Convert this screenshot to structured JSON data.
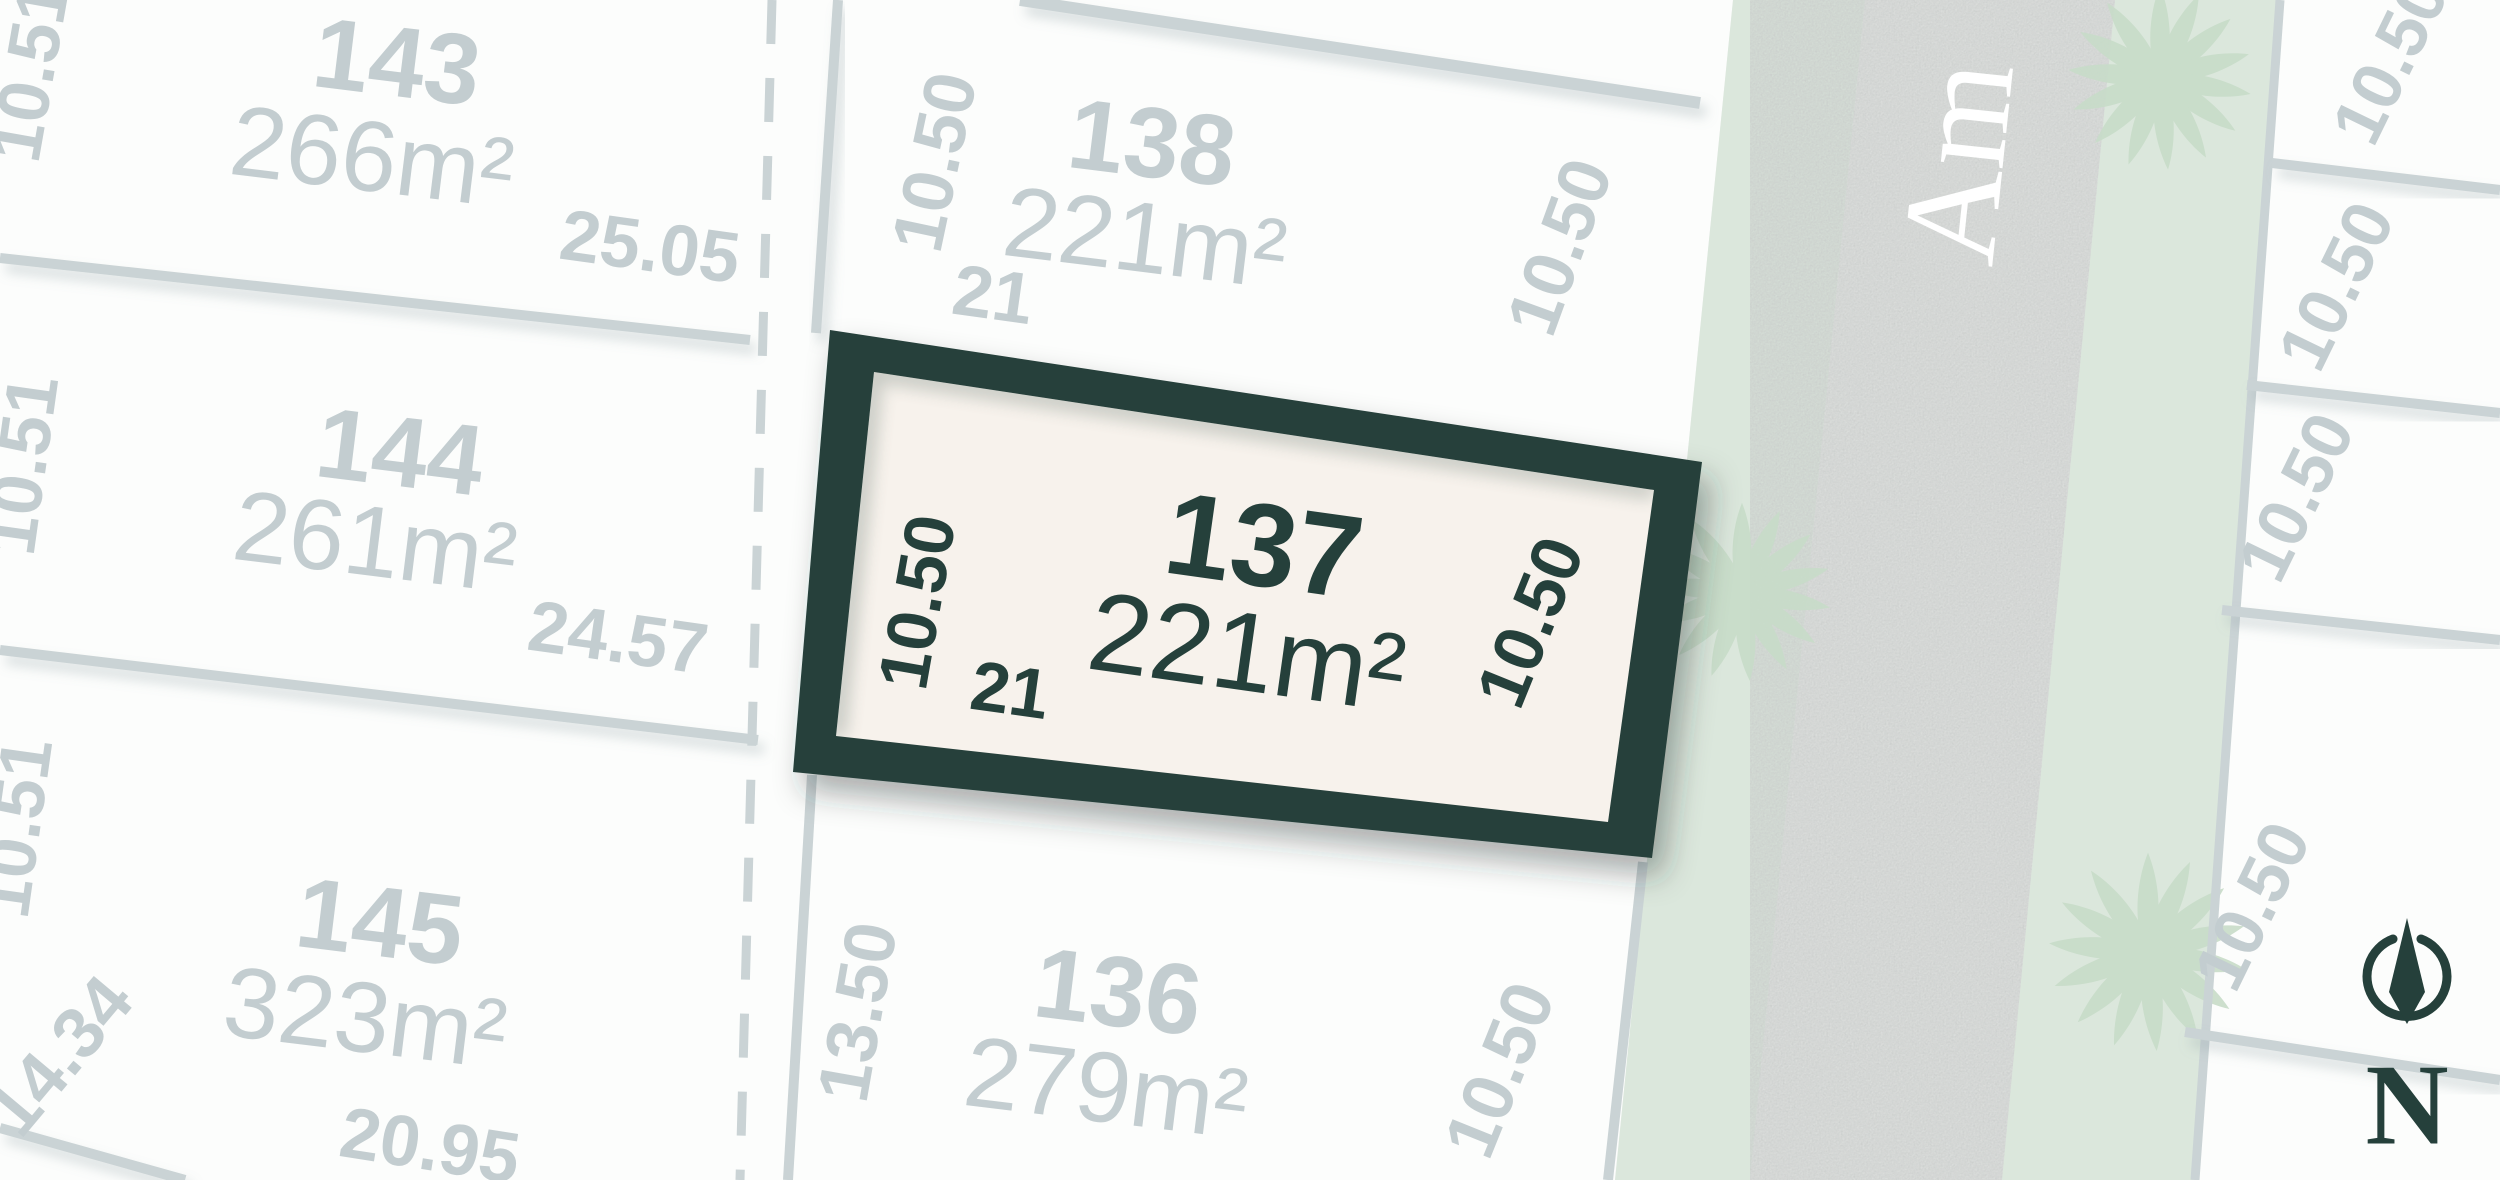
{
  "colors": {
    "accent_dark": "#25403b",
    "label_gray": "#c3cdd0",
    "line_gray": "#cad3d5",
    "lot_fill": "#fcfdfc",
    "background": "#eef1f0",
    "road_fill": "#e4e6e4",
    "verge_green": "#dbe7dc",
    "tree_green": "#c8dcc9",
    "highlight_fill": "#f7f2ec",
    "street_text": "#ffffff"
  },
  "highlight_lot": {
    "number": "137",
    "area": "221m²",
    "dim_left": "10.50",
    "dim_frontage": "21",
    "dim_right": "10.50"
  },
  "lots": {
    "l143": {
      "number": "143",
      "area": "266m²",
      "dim_side": "10.51",
      "dim_rear": "25.05"
    },
    "l144": {
      "number": "144",
      "area": "261m²",
      "dim_side": "10.51",
      "dim_rear": "24.57"
    },
    "l145": {
      "number": "145",
      "area": "323m²",
      "dim_side": "10.51",
      "dim_side2": "14.34",
      "dim_rear": "20.95"
    },
    "l138": {
      "number": "138",
      "area": "221m²",
      "dim_left": "10.50",
      "dim_frontage": "21",
      "dim_right": "10.50"
    },
    "l136": {
      "number": "136",
      "area": "279m²",
      "dim_left": "13.50",
      "dim_right": "10.50"
    }
  },
  "right_lots": {
    "frontages": [
      "10.50",
      "10.50",
      "10.50",
      "10.50"
    ]
  },
  "street": {
    "visible_name": "Am"
  },
  "compass": {
    "label": "N"
  }
}
